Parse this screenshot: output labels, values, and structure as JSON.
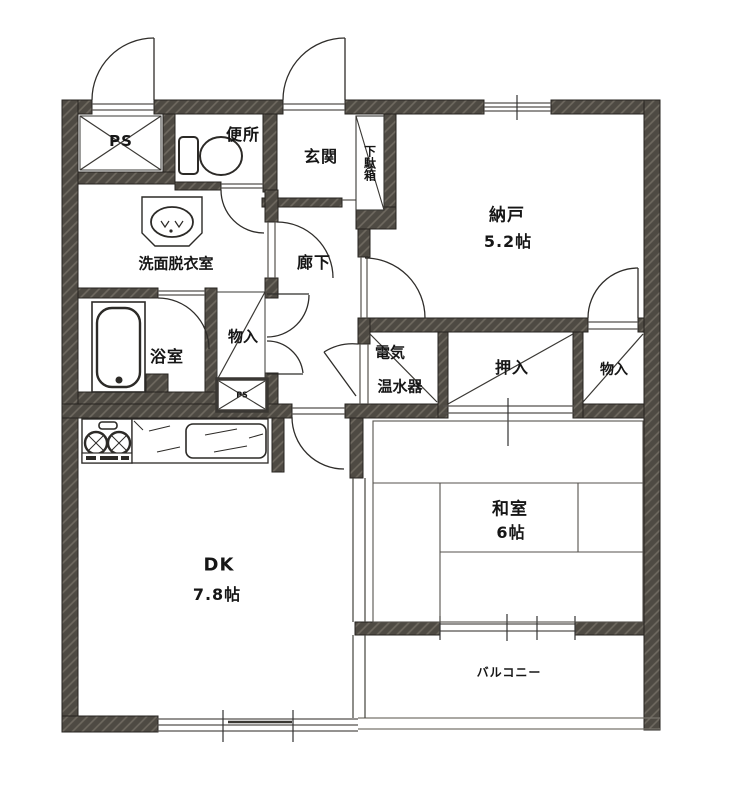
{
  "plan": {
    "rooms": {
      "ps_top": {
        "label": "PS"
      },
      "toilet": {
        "label": "便所"
      },
      "entrance": {
        "label": "玄関"
      },
      "shoe_cabinet": {
        "label": "下駄箱"
      },
      "storage_room": {
        "label": "納戸",
        "size": "5.2帖"
      },
      "washroom": {
        "label": "洗面脱衣室"
      },
      "hallway": {
        "label": "廊下"
      },
      "bathroom": {
        "label": "浴室"
      },
      "hall_closet": {
        "label": "物入"
      },
      "ps_small": {
        "label": "PS"
      },
      "water_heater": {
        "line1": "電気",
        "line2": "温水器"
      },
      "oshiire": {
        "label": "押入"
      },
      "storage_right": {
        "label": "物入"
      },
      "dining_kitchen": {
        "label": "DK",
        "size": "7.8帖"
      },
      "japanese_room": {
        "label": "和室",
        "size": "6帖"
      },
      "balcony": {
        "label": "バルコニー"
      }
    },
    "colors": {
      "wall": "#4e4a43",
      "wall_hatch": "#8a8378",
      "line": "#2e2c29",
      "background": "#ffffff"
    }
  }
}
